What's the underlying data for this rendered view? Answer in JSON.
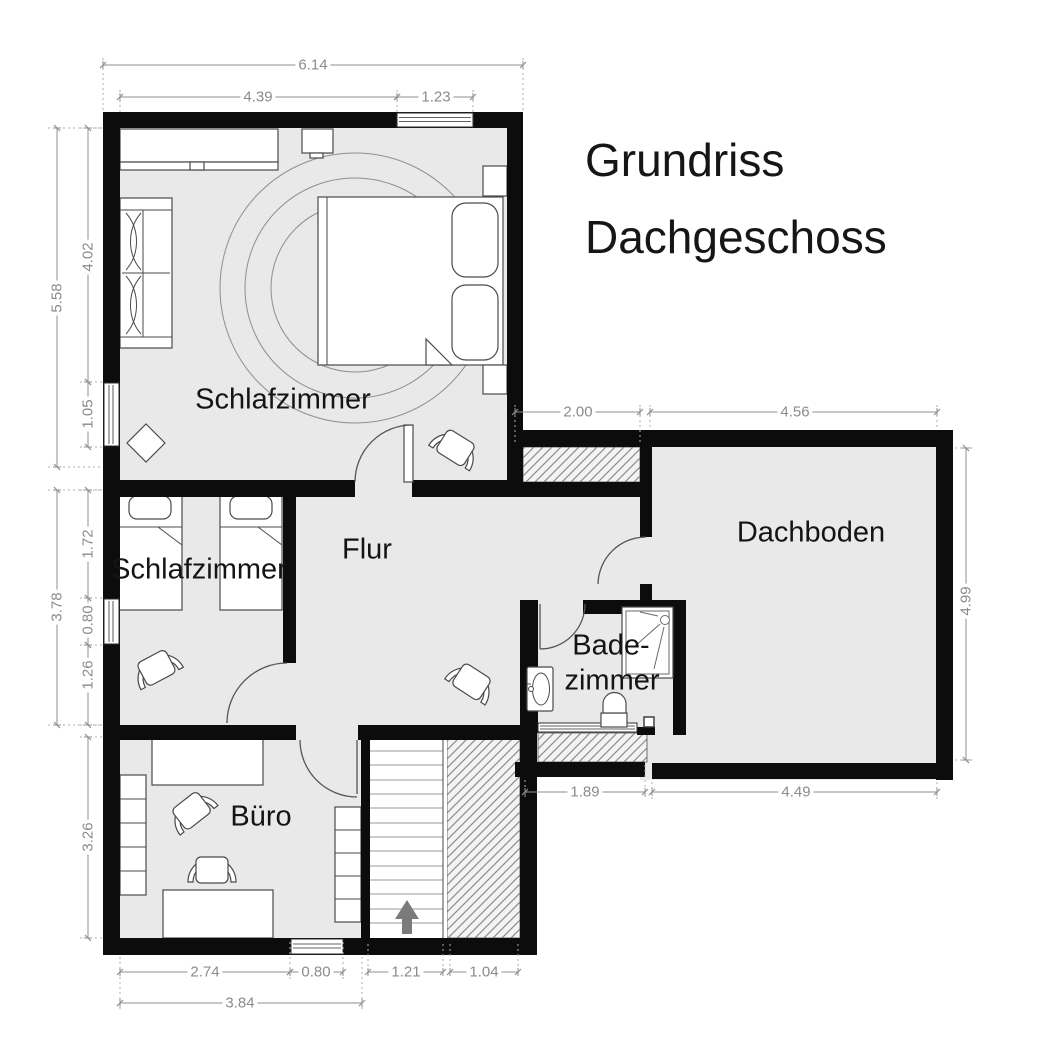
{
  "title": {
    "line1": "Grundriss",
    "line2": "Dachgeschoss"
  },
  "rooms": {
    "schlafzimmer1": "Schlafzimmer",
    "schlafzimmer2": "Schlafzimmer",
    "flur": "Flur",
    "buero": "Büro",
    "badezimmer_line1": "Bade-",
    "badezimmer_line2": "zimmer",
    "dachboden": "Dachboden"
  },
  "dimensions": {
    "top_total": "6.14",
    "top_left": "4.39",
    "top_window": "1.23",
    "left_upper_total": "5.58",
    "left_upper": "4.02",
    "left_upper_window": "1.05",
    "left_middle_total": "3.78",
    "left_mid_upper": "1.72",
    "left_mid_window": "0.80",
    "left_mid_lower": "1.26",
    "left_lower": "3.26",
    "bottom_buero": "2.74",
    "bottom_window": "0.80",
    "bottom_stairs": "1.21",
    "bottom_void": "1.04",
    "bottom_total": "3.84",
    "corridor_top": "2.00",
    "dachboden_top": "4.56",
    "dachboden_right": "4.99",
    "bottom_mid_left": "1.89",
    "dachboden_bottom": "4.49"
  },
  "colors": {
    "wall": "#0c0c0c",
    "floor": "#e9e9e9",
    "furniture_outline": "#4a4a4a",
    "dimension": "#8b8b8b",
    "stair_arrow": "#7b7b7b"
  },
  "furniture": [
    "double-bed",
    "wardrobe",
    "nightstand",
    "sofa",
    "round-rug",
    "armchair",
    "single-bed",
    "single-bed",
    "office-table",
    "desk",
    "desk-chair",
    "bookshelf",
    "stairs-up",
    "shower",
    "sink",
    "toilet"
  ]
}
